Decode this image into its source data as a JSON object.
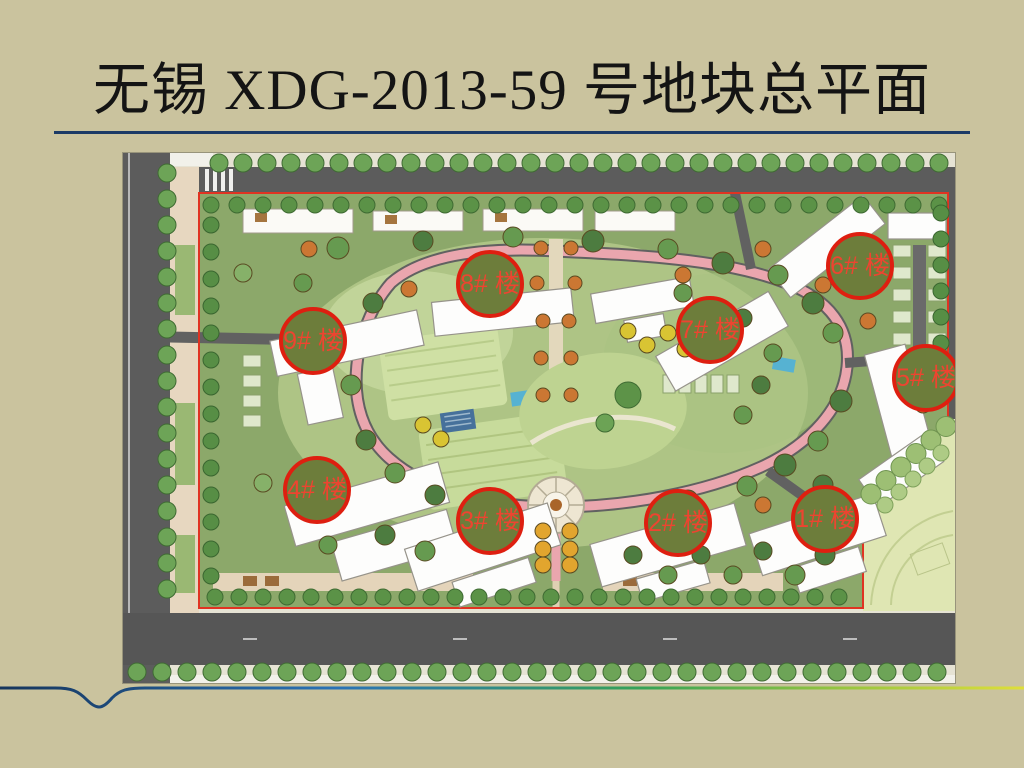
{
  "title": {
    "line1": "无锡 XDG-2013-59 号地块总平面",
    "line2": "图",
    "text_color": "#141414",
    "rule_color": "#1b3a66"
  },
  "plan": {
    "type": "residential site master plan",
    "markers": [
      {
        "label": "1# 楼"
      },
      {
        "label": "2# 楼"
      },
      {
        "label": "3# 楼"
      },
      {
        "label": "4# 楼"
      },
      {
        "label": "5# 楼"
      },
      {
        "label": "6# 楼"
      },
      {
        "label": "7# 楼"
      },
      {
        "label": "8# 楼"
      },
      {
        "label": "9# 楼"
      }
    ],
    "marker_colors": {
      "fill": "#6d7d3b",
      "border": "#de1f10",
      "text": "#ee4430"
    }
  },
  "slide_colors": {
    "background": "#cac39e",
    "decoration_gradient": [
      "#16355c",
      "#2a72b5",
      "#36a356",
      "#96c53f",
      "#dfdf3a"
    ]
  }
}
